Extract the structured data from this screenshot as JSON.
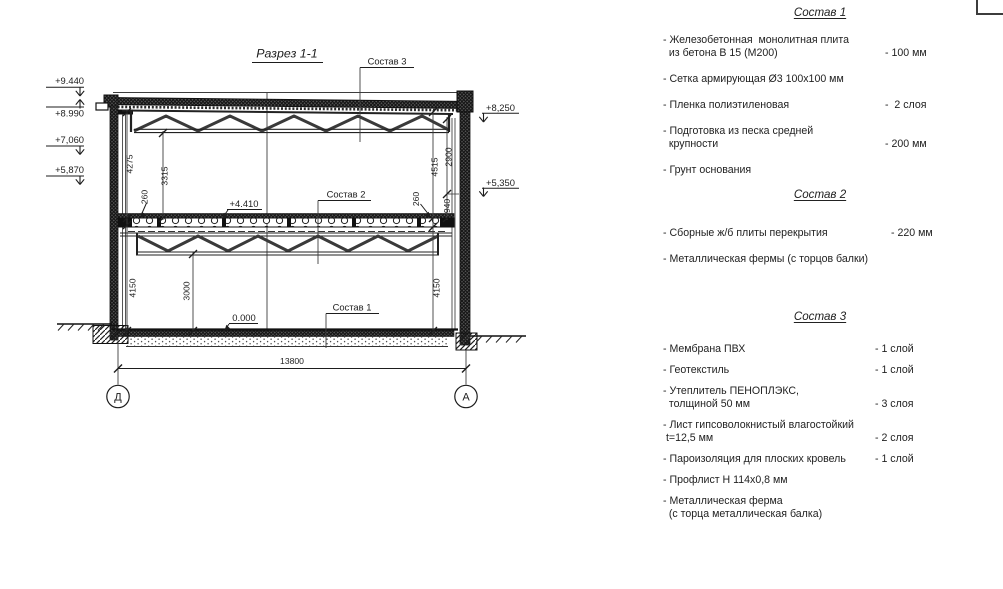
{
  "drawing": {
    "title": "Разрез 1-1",
    "axis_left": "Д",
    "axis_right": "А",
    "elevations": {
      "p9440": "+9.440",
      "p8990": "+8.990",
      "p7060": "+7,060",
      "p5870": "+5,870",
      "p8250": "+8,250",
      "p5350": "+5,350",
      "p4410": "+4.410",
      "p0000": "0.000"
    },
    "dimensions": {
      "d4275": "4275",
      "d3315": "3315",
      "d260_left": "260",
      "d4150_left": "4150",
      "d3000": "3000",
      "d13800": "13800",
      "d4515": "4515",
      "d2900": "2900",
      "d260_right": "260",
      "d940": "940",
      "d4150_right": "4150"
    },
    "callouts": {
      "c1": "Состав 1",
      "c2": "Состав 2",
      "c3": "Состав 3"
    }
  },
  "legend": {
    "sections": [
      {
        "heading": "Состав 1",
        "items": [
          {
            "label": "- Железобетонная  монолитная плита\n  из бетона В 15 (М200)",
            "value": "- 100 мм"
          },
          {
            "label": "- Сетка армирующая Ø3 100х100 мм",
            "value": ""
          },
          {
            "label": "- Пленка полиэтиленовая",
            "value": "-  2 слоя"
          },
          {
            "label": "- Подготовка из песка средней\n  крупности",
            "value": "- 200 мм"
          },
          {
            "label": "- Грунт основания",
            "value": ""
          }
        ]
      },
      {
        "heading": "Состав 2",
        "items": [
          {
            "label": "- Сборные ж/б плиты перекрытия",
            "value": "- 220 мм"
          },
          {
            "label": "- Металлическая фермы (с торцов балки)",
            "value": ""
          }
        ]
      },
      {
        "heading": "Состав 3",
        "items": [
          {
            "label": "- Мембрана ПВХ",
            "value": "- 1 слой"
          },
          {
            "label": "- Геотекстиль",
            "value": "- 1 слой"
          },
          {
            "label": "- Утеплитель ПЕНОПЛЭКС,\n  толщиной 50 мм",
            "value": "- 3 слоя"
          },
          {
            "label": "- Лист гипсоволокнистый влагостойкий\n t=12,5 мм",
            "value": "- 2 слоя"
          },
          {
            "label": "- Пароизоляция для плоских кровель",
            "value": "- 1 слой"
          },
          {
            "label": "- Профлист Н 114х0,8 мм",
            "value": ""
          },
          {
            "label": "- Металлическая ферма\n  (с торца металлическая балка)",
            "value": ""
          }
        ]
      }
    ]
  }
}
